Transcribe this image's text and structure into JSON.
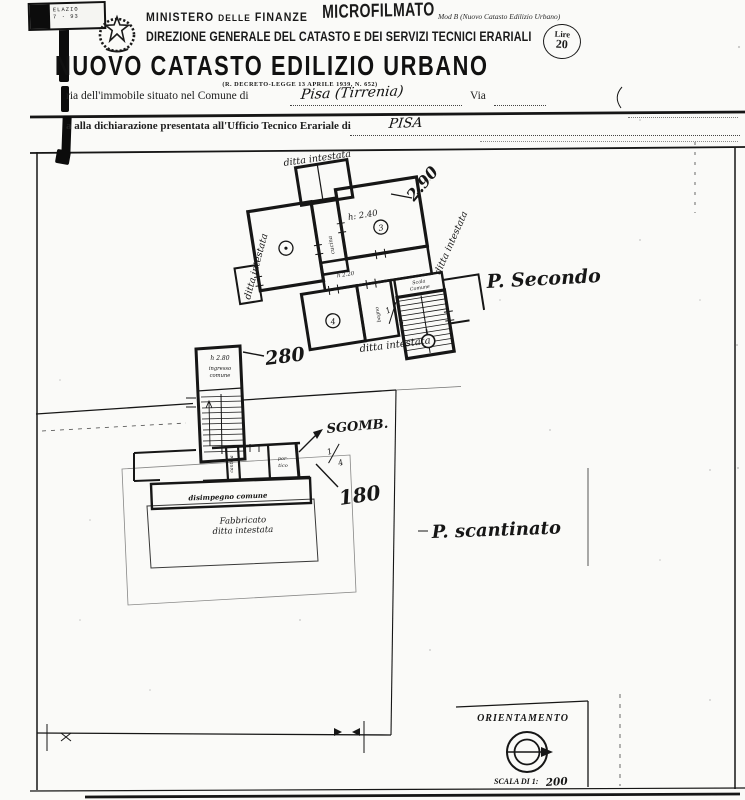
{
  "document": {
    "paper": "#fafaf8",
    "ink": "#1a1a1a"
  },
  "header": {
    "binding_stamp": {
      "line1": "ELAZIO",
      "line2": "7 · 93"
    },
    "ministry_part1": "MINISTERO ",
    "ministry_part2": "DELLE",
    "ministry_part3": " FINANZE",
    "microfilm_stamp": "MICROFILMATO",
    "mod_label": "Mod B (Nuovo Catasto Edilizio Urbano)",
    "direction": "DIREZIONE GENERALE DEL CATASTO E DEI SERVIZI TECNICI ERARIALI",
    "fee": {
      "currency": "Lire",
      "amount": "20"
    },
    "title": "NUOVO CATASTO EDILIZIO URBANO",
    "subtitle": "(R. DECRETO-LEGGE 13 APRILE 1939, N. 652)",
    "line1": {
      "prefix": "ria dell'immobile situato nel Comune di",
      "value": "Pisa (Tirrenia)",
      "suffix": "Via"
    },
    "line2": {
      "prefix": "a alla dichiarazione presentata all'Ufficio Tecnico Erariale di",
      "value": "PISA"
    }
  },
  "plan": {
    "second_floor": {
      "label": "P. Secondo",
      "ditta_top": "ditta intestata",
      "ditta_left": "ditta intestata",
      "ditta_right": "ditta intestata",
      "ditta_bottom": "ditta intestata",
      "room_height": "h: 2.40",
      "corridor_height": "h 2.20",
      "dim_height": "2.90",
      "stair_line1": "Scala",
      "stair_line2": "Comune",
      "room_mid_label": "cucina",
      "room_bath_label": "bagno",
      "room_b_no": "3",
      "room_c_no": "4",
      "fraction_num": "1",
      "fraction_den": "3"
    },
    "basement": {
      "label": "P. scantinato",
      "strip_height": "h 2.80",
      "strip_line1": "ingresso",
      "strip_line2": "comune",
      "dim_280": "280",
      "dim_180": "180",
      "sgomb_label": "SGOMB.",
      "fraction_num": "1",
      "fraction_den": "4",
      "disimpegno_label": "disimpegno comune",
      "fabbricato_line1": "Fabbricato",
      "fabbricato_line2": "ditta intestata",
      "cantina_label": "cantina",
      "portico_line1": "por-",
      "portico_line2": "tico"
    },
    "orientation": {
      "title": "ORIENTAMENTO",
      "scale_prefix": "SCALA DI 1:",
      "scale_value": "200"
    }
  }
}
